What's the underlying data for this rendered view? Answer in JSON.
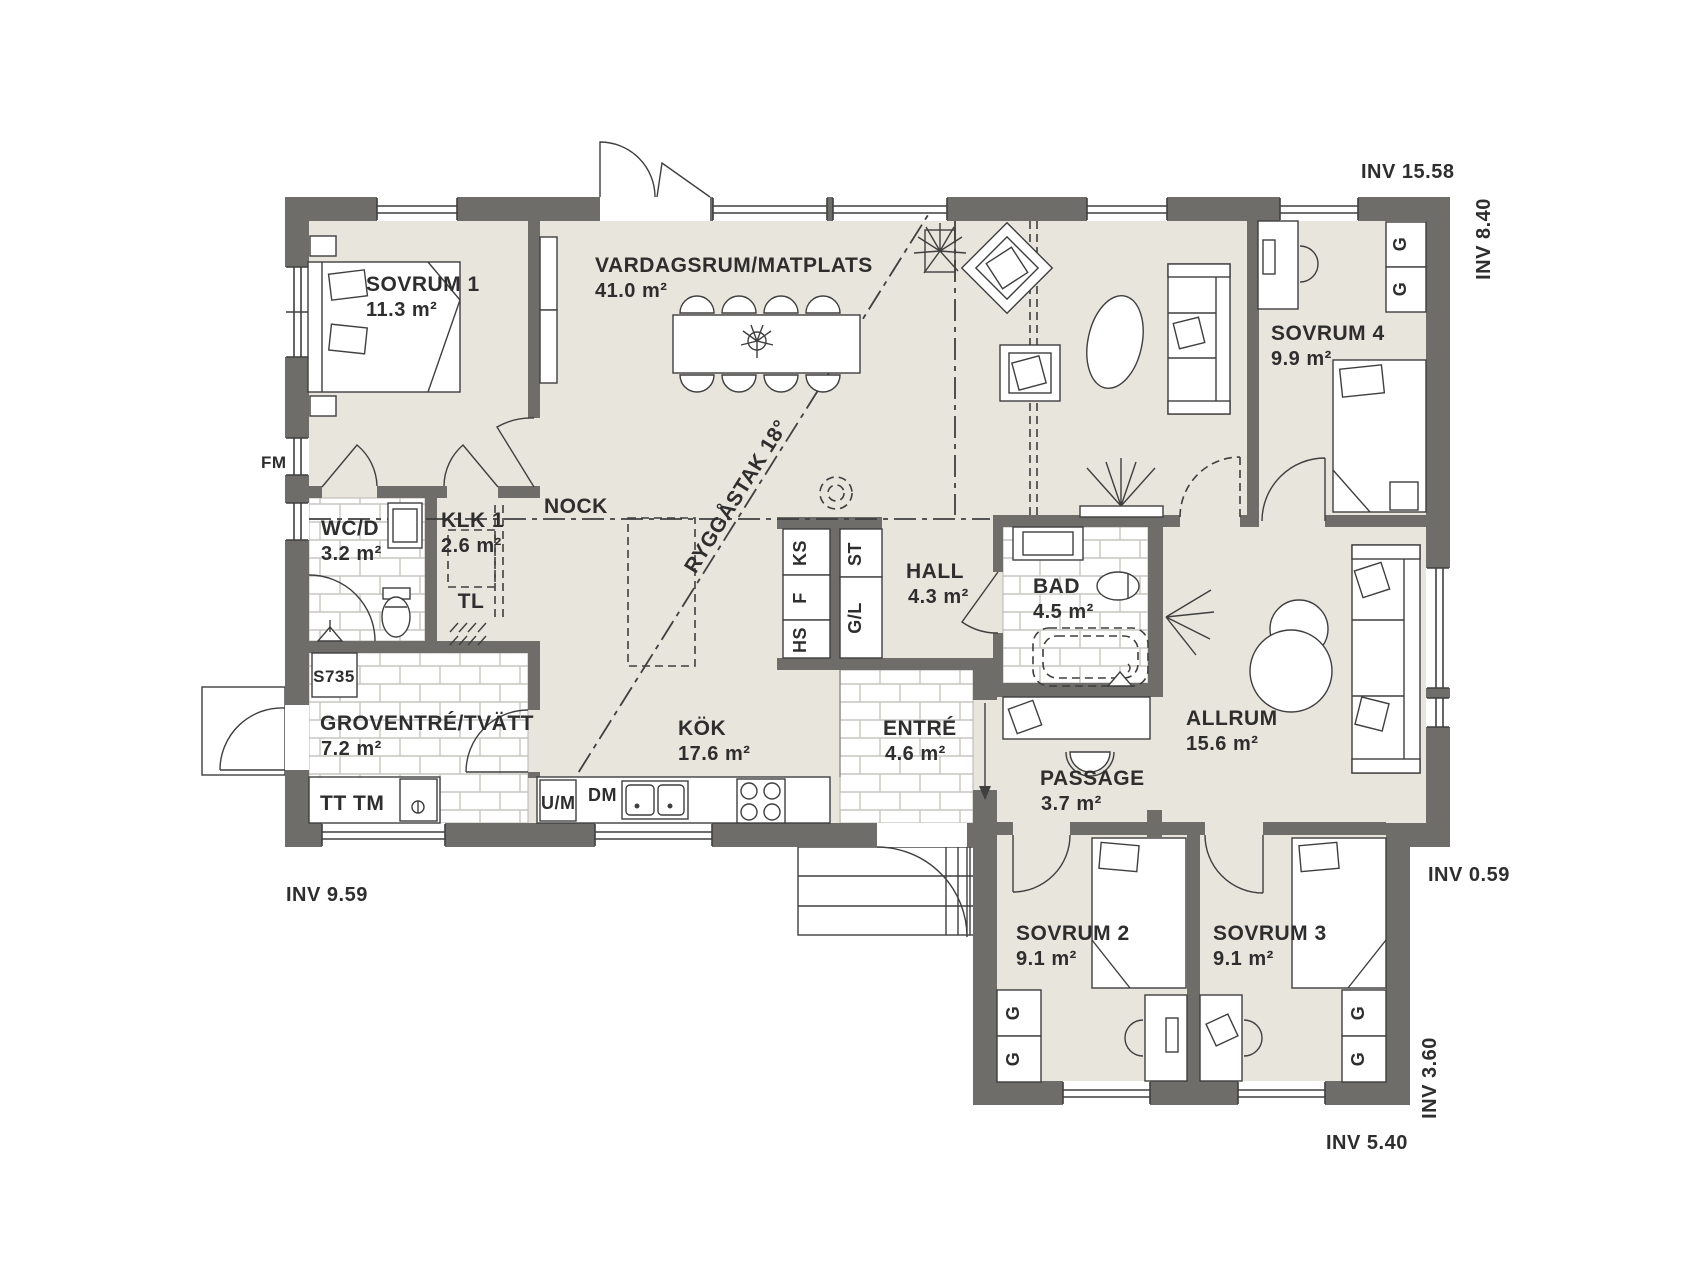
{
  "title": "Floor plan",
  "rooms": [
    {
      "name": "SOVRUM 1",
      "area": "11.3 m²"
    },
    {
      "name": "VARDAGSRUM/MATPLATS",
      "area": "41.0 m²"
    },
    {
      "name": "SOVRUM 4",
      "area": "9.9 m²"
    },
    {
      "name": "WC/D",
      "area": "3.2 m²"
    },
    {
      "name": "KLK 1",
      "area": "2.6 m²"
    },
    {
      "name": "HALL",
      "area": "4.3 m²"
    },
    {
      "name": "BAD",
      "area": "4.5 m²"
    },
    {
      "name": "GROVENTRÉ/TVÄTT",
      "area": "7.2 m²"
    },
    {
      "name": "KÖK",
      "area": "17.6 m²"
    },
    {
      "name": "ENTRÉ",
      "area": "4.6 m²"
    },
    {
      "name": "PASSAGE",
      "area": "3.7 m²"
    },
    {
      "name": "ALLRUM",
      "area": "15.6 m²"
    },
    {
      "name": "SOVRUM 2",
      "area": "9.1 m²"
    },
    {
      "name": "SOVRUM 3",
      "area": "9.1 m²"
    }
  ],
  "dimensions": {
    "top_right": "INV 15.58",
    "right_upper": "INV 8.40",
    "right_step": "INV 0.59",
    "right_lower": "INV 3.60",
    "bottom_right": "INV 5.40",
    "bottom_left": "INV 9.59"
  },
  "annotations": {
    "ridge": "NOCK",
    "roof_slope": "RYGGÅSTAK 18°",
    "attic_hatch": "TL",
    "window_code": "FM",
    "door_code": "S735"
  },
  "appliances": {
    "fridge": "KS",
    "freezer": "F",
    "tall_cabinet": "HS",
    "cleaning_cabinet": "ST",
    "wardrobe_linen": "G/L",
    "dishwasher": "DM",
    "oven_micro": "U/M",
    "washer_dryer": "TT TM",
    "wardrobe": "G"
  },
  "colors": {
    "wall": "#6f6d6a",
    "floor": "#e8e5dc",
    "line": "#3f3f3f",
    "tile_grout": "#c9c6c0"
  }
}
